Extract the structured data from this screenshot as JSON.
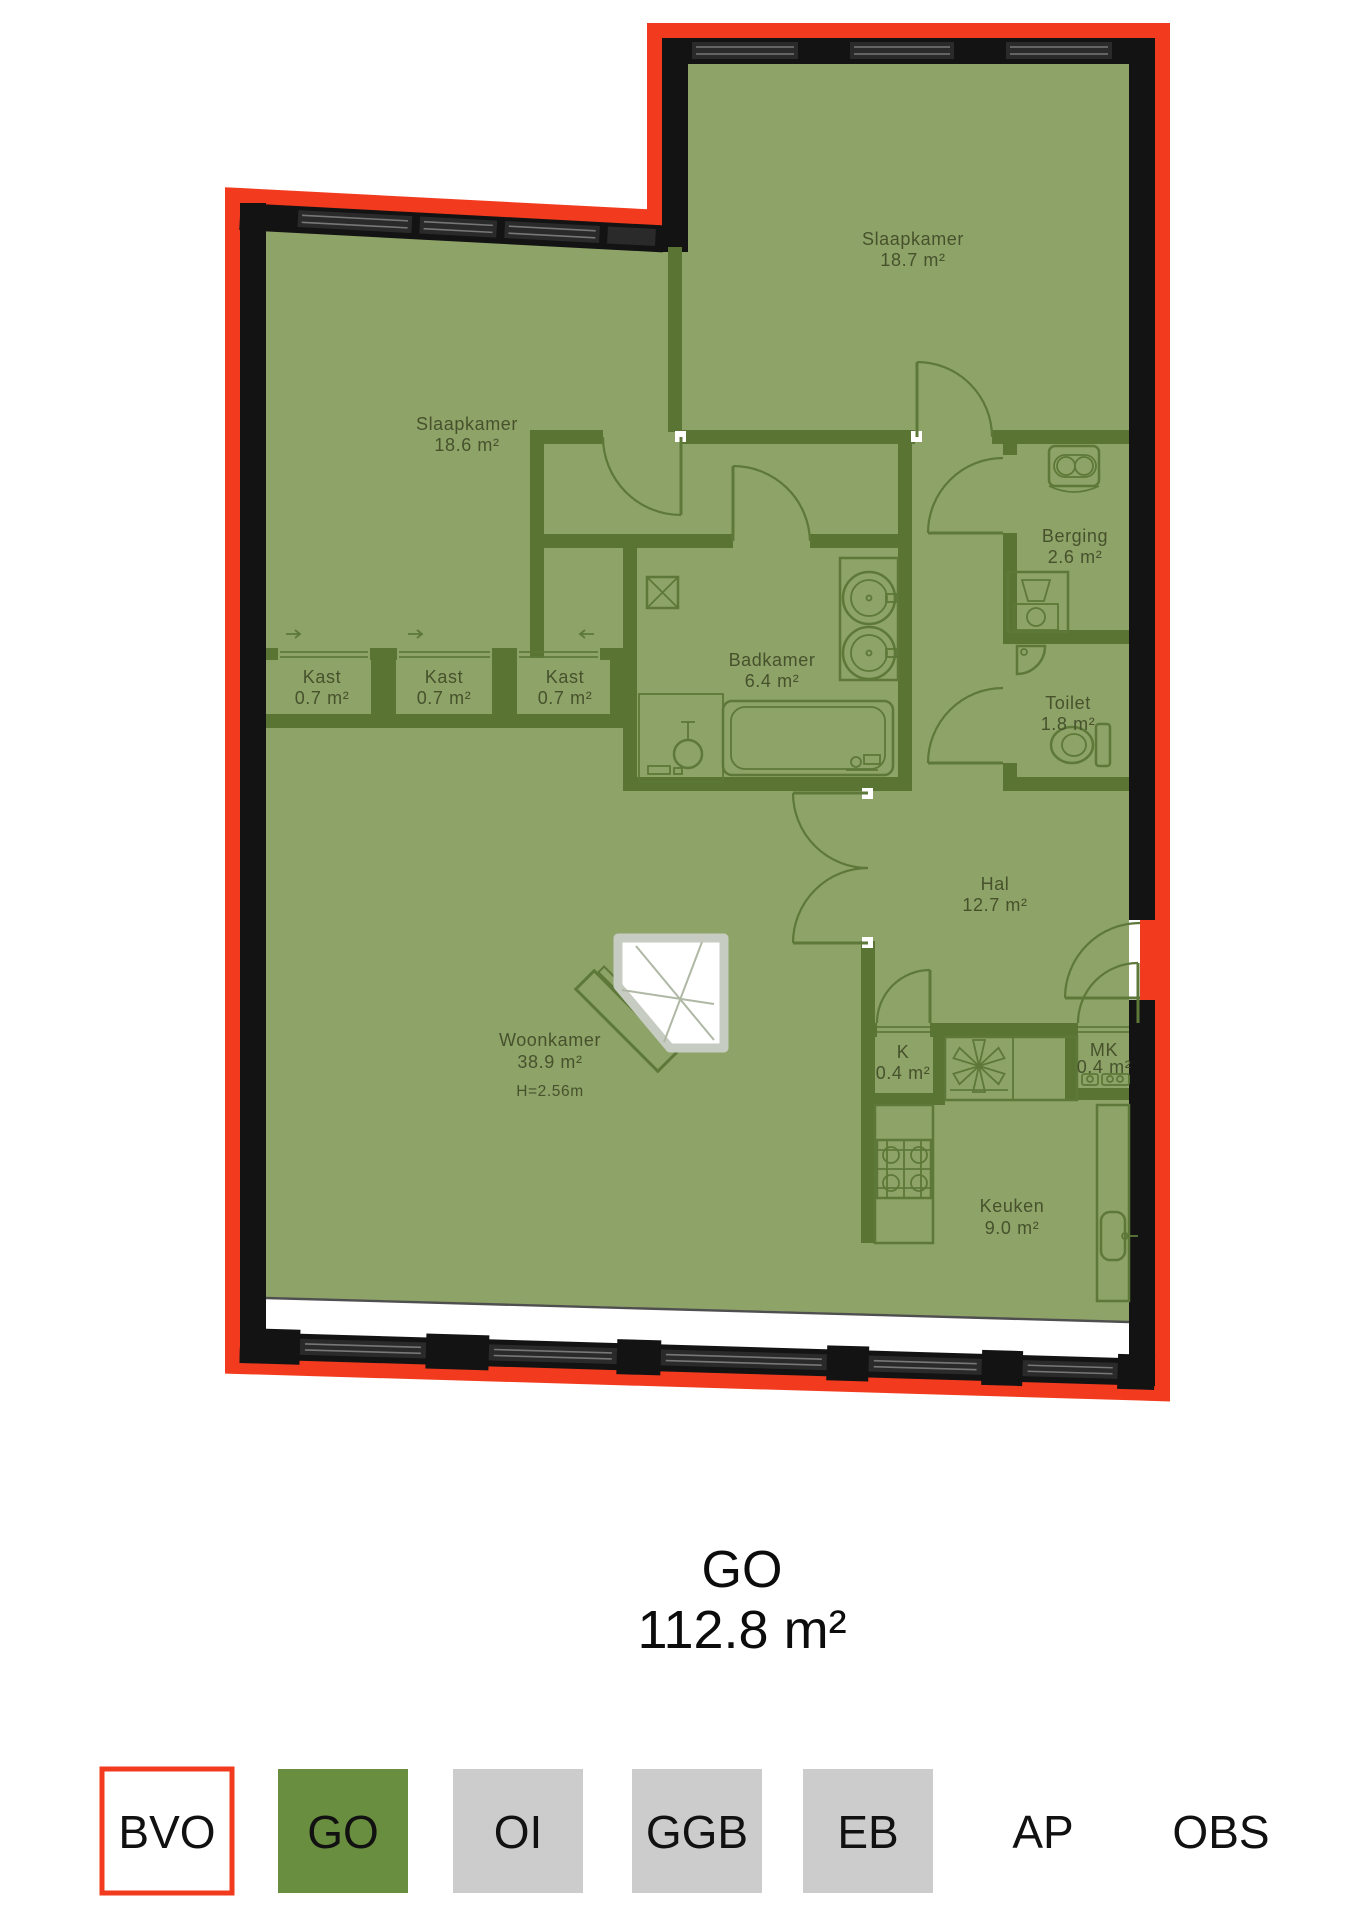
{
  "floorplan": {
    "rooms": [
      {
        "id": "slaapkamer-2",
        "name": "Slaapkamer",
        "area": "18.7 m²"
      },
      {
        "id": "slaapkamer-1",
        "name": "Slaapkamer",
        "area": "18.6 m²"
      },
      {
        "id": "berging",
        "name": "Berging",
        "area": "2.6 m²"
      },
      {
        "id": "kast-1",
        "name": "Kast",
        "area": "0.7 m²"
      },
      {
        "id": "kast-2",
        "name": "Kast",
        "area": "0.7 m²"
      },
      {
        "id": "kast-3",
        "name": "Kast",
        "area": "0.7 m²"
      },
      {
        "id": "badkamer",
        "name": "Badkamer",
        "area": "6.4 m²"
      },
      {
        "id": "toilet",
        "name": "Toilet",
        "area": "1.8 m²"
      },
      {
        "id": "hal",
        "name": "Hal",
        "area": "12.7 m²"
      },
      {
        "id": "woonkamer",
        "name": "Woonkamer",
        "area": "38.9 m²",
        "height": "H=2.56m"
      },
      {
        "id": "k",
        "name": "K",
        "area": "0.4 m²"
      },
      {
        "id": "mk",
        "name": "MK",
        "area": "0.4 m²"
      },
      {
        "id": "keuken",
        "name": "Keuken",
        "area": "9.0 m²"
      }
    ],
    "icons": [
      "washing-machine-icon",
      "dryer-icon",
      "lamp-icon",
      "bathtub-icon",
      "washbasin-icon",
      "shower-icon",
      "toilet-icon",
      "hand-basin-icon",
      "shaft-icon",
      "stove-icon",
      "extractor-fan-icon",
      "kitchen-sink-icon",
      "meter-icon",
      "glass-partition-icon",
      "door-arc",
      "window"
    ]
  },
  "summary": {
    "label": "GO",
    "area": "112.8 m²"
  },
  "legend": {
    "items": [
      {
        "label": "BVO",
        "fill": "#ffffff",
        "border": "#F23B1E"
      },
      {
        "label": "GO",
        "fill": "#6A8E3F"
      },
      {
        "label": "OI",
        "fill": "#CCCCCC"
      },
      {
        "label": "GGB",
        "fill": "#CCCCCC"
      },
      {
        "label": "EB",
        "fill": "#CCCCCC"
      },
      {
        "label": "AP",
        "fill": "none"
      },
      {
        "label": "OBS",
        "fill": "none"
      }
    ]
  },
  "colors": {
    "floor": "#8EA367",
    "interior_wall": "#5A7433",
    "outer_wall": "#131313",
    "bvo_outline": "#F23B1E",
    "label_text": "#47522D",
    "legend_gray": "#CCCCCC",
    "legend_green": "#6A8E3F"
  }
}
